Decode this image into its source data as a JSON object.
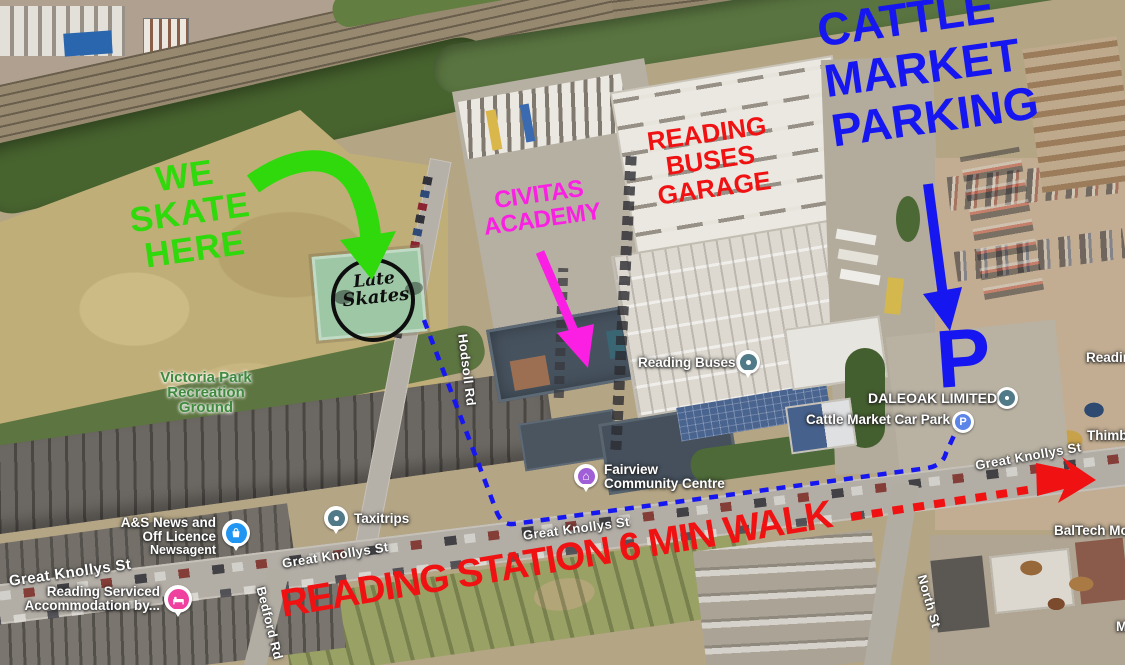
{
  "colors": {
    "annotation_green": "#2fd90c",
    "annotation_magenta": "#fb1fe3",
    "annotation_red": "#f01212",
    "annotation_blue": "#1616f0"
  },
  "annotations": {
    "we_skate": {
      "line1": "WE",
      "line2": "SKATE",
      "line3": "HERE"
    },
    "civitas": {
      "line1": "CIVITAS",
      "line2": "ACADEMY"
    },
    "buses_garage": {
      "line1": "READING",
      "line2": "BUSES",
      "line3": "GARAGE"
    },
    "cattle": {
      "line1": "CATTLE",
      "line2": "MARKET",
      "line3": "PARKING"
    },
    "parking_letter": "P",
    "station": "READING STATION 6 MIN WALK"
  },
  "skate_logo": {
    "line1": "Late",
    "line2": "Skates"
  },
  "park_label": {
    "line1": "Victoria Park",
    "line2": "Recreation",
    "line3": "Ground"
  },
  "streets": {
    "hodsoll": "Hodsoll Rd",
    "great_knollys": "Great Knollys St",
    "bedford": "Bedford Rd",
    "north": "North St"
  },
  "pois": {
    "taxitrips": {
      "label": "Taxitrips"
    },
    "reading_buses": {
      "label": "Reading Buses"
    },
    "fairview": {
      "line1": "Fairview",
      "line2": "Community Centre"
    },
    "newsagent": {
      "line1": "A&S News and",
      "line2": "Off Licence",
      "line3": "Newsagent"
    },
    "serviced": {
      "line1": "Reading Serviced",
      "line2": "Accommodation by..."
    },
    "cattle_carpark": {
      "label": "Cattle Market Car Park",
      "icon_letter": "P"
    },
    "daleoak": {
      "label": "DALEOAK LIMITED"
    }
  },
  "edge_labels": {
    "reading_partial": "Readin",
    "thimble_partial": "Thimbl",
    "baltech": "BalTech Mo",
    "m_partial": "M"
  }
}
